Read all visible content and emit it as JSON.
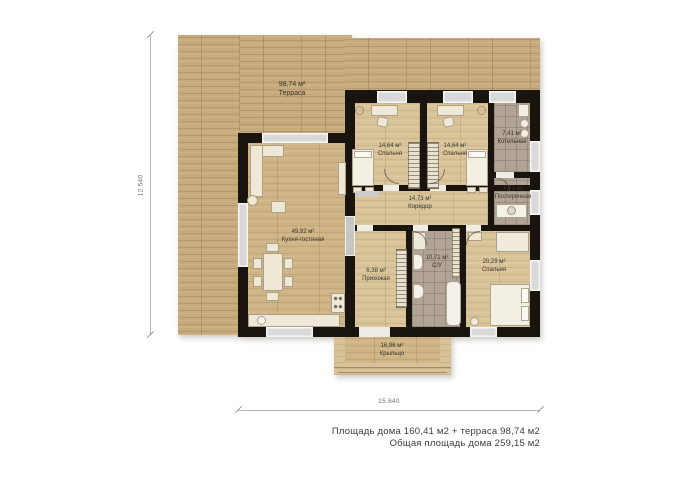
{
  "rooms": [
    {
      "id": "terrace",
      "area": "98,74 м²",
      "name": "Терраса"
    },
    {
      "id": "bedroom-1",
      "area": "14,64 м²",
      "name": "Спальня"
    },
    {
      "id": "bedroom-2",
      "area": "14,64 м²",
      "name": "Спальня"
    },
    {
      "id": "boiler-room",
      "area": "7,41 м²",
      "name": "Котельная"
    },
    {
      "id": "laundry",
      "area": "4,73 м²",
      "name": "Постирочная"
    },
    {
      "id": "corridor",
      "area": "14,73 м²",
      "name": "Коридор"
    },
    {
      "id": "kitchen-living",
      "area": "49,92 м²",
      "name": "Кухня-гостиная"
    },
    {
      "id": "entry-hall",
      "area": "6,38 м²",
      "name": "Прихожая"
    },
    {
      "id": "bathroom",
      "area": "10,71 м²",
      "name": "С/У"
    },
    {
      "id": "bedroom-3",
      "area": "20,29 м²",
      "name": "Спальня"
    },
    {
      "id": "porch",
      "area": "16,96 м²",
      "name": "Крыльцо"
    }
  ],
  "dimensions": {
    "height": "12.540",
    "width": "15.640"
  },
  "summary": {
    "line1": "Площадь дома 160,41 м2 + терраса 98,74 м2",
    "line2": "Общая площадь дома 259,15 м2"
  },
  "palette": {
    "terrace_wood": "#c7ab7c",
    "interior_wood": "#d9c49a",
    "tile": "#b1a395",
    "wall": "#19140e"
  }
}
